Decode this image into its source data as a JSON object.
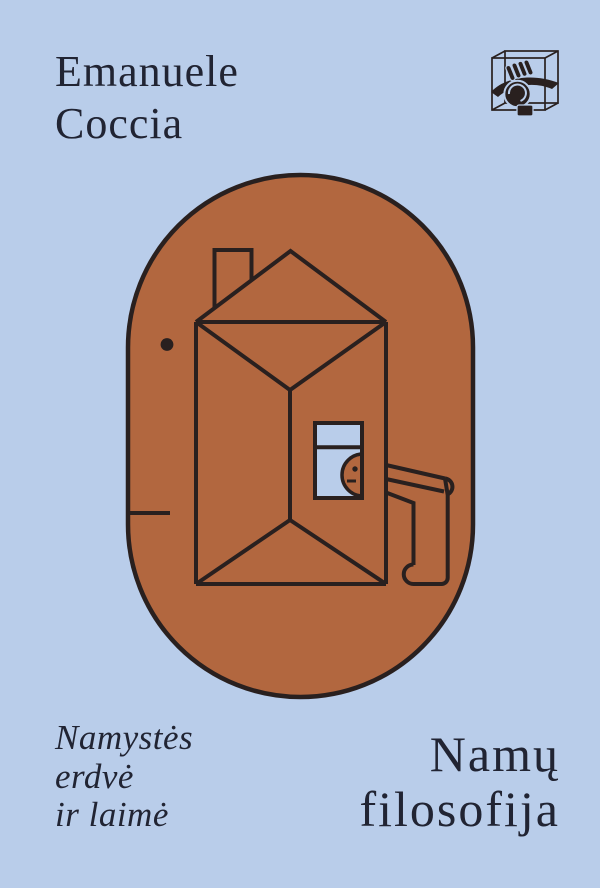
{
  "colors": {
    "background": "#b9cdea",
    "oval_fill": "#b2673f",
    "ink": "#29201f",
    "text": "#212433"
  },
  "author": {
    "line1": "Emanuele",
    "line2": "Coccia"
  },
  "publisher": {
    "logo_icon": "fist-in-cube"
  },
  "subtitle": {
    "line1": "Namystės",
    "line2": "erdvė",
    "line3": "ir laimė"
  },
  "title": {
    "line1": "Namų",
    "line2": "filosofija"
  }
}
